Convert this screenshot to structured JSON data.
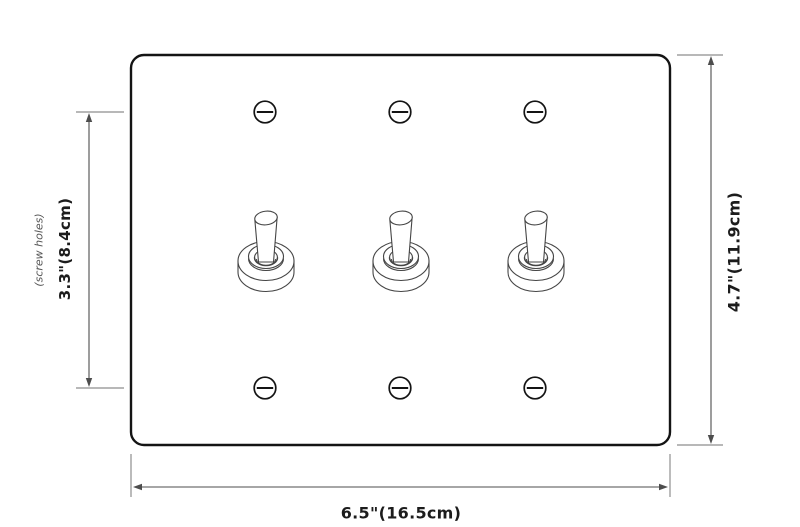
{
  "figure": {
    "type": "dimension-diagram",
    "subject": "3-toggle switch wall plate technical drawing",
    "toggle_count": 3,
    "screw_count": 6
  },
  "labels": {
    "plate_width": "6.5\"(16.5cm)",
    "plate_height": "4.7\"(11.9cm)",
    "screw_spacing": "3.3\"(8.4cm)",
    "screw_spacing_note": "(screw holes)"
  },
  "colors": {
    "background": "#ffffff",
    "plate_outline": "#141414",
    "switch_outline": "#454545",
    "dimension_line": "#4d4d4d",
    "extension_line": "#8e8e8e",
    "label_text": "#1c1c1c",
    "note_text": "#555555"
  }
}
